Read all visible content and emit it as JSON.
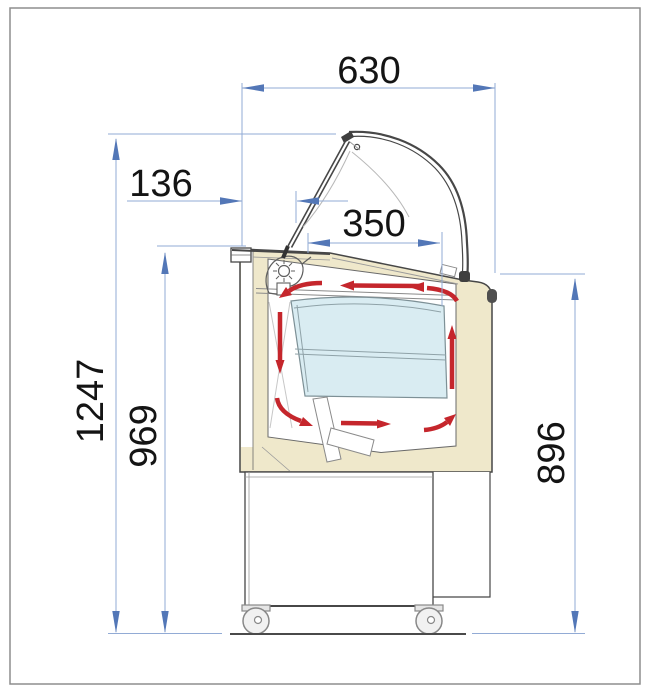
{
  "diagram": {
    "type": "technical-drawing",
    "subject": "ice cream display counter side cross-section with internal air circulation",
    "units": "mm"
  },
  "dimensions": {
    "total_width": "630",
    "glass_front_offset": "136",
    "display_depth": "350",
    "total_height": "1247",
    "worktop_height": "969",
    "rear_height": "896"
  },
  "colors": {
    "dim-line": "#92abd5",
    "dim-arrow": "#5377b7",
    "dim-text": "#141414",
    "outline": "#474747",
    "outline-light": "#9a9a9a",
    "body-beige": "#efe8cb",
    "tub-blue": "#d9ecf2",
    "flow-red": "#c5262c",
    "frame-gray": "#8d8d8d",
    "paper-white": "#ffffff"
  },
  "icons": {
    "lamp": "lamp-icon",
    "fan": "fan-scroll-icon",
    "caster": "caster-wheel-icon",
    "airflow": "airflow-arrow-icon"
  }
}
